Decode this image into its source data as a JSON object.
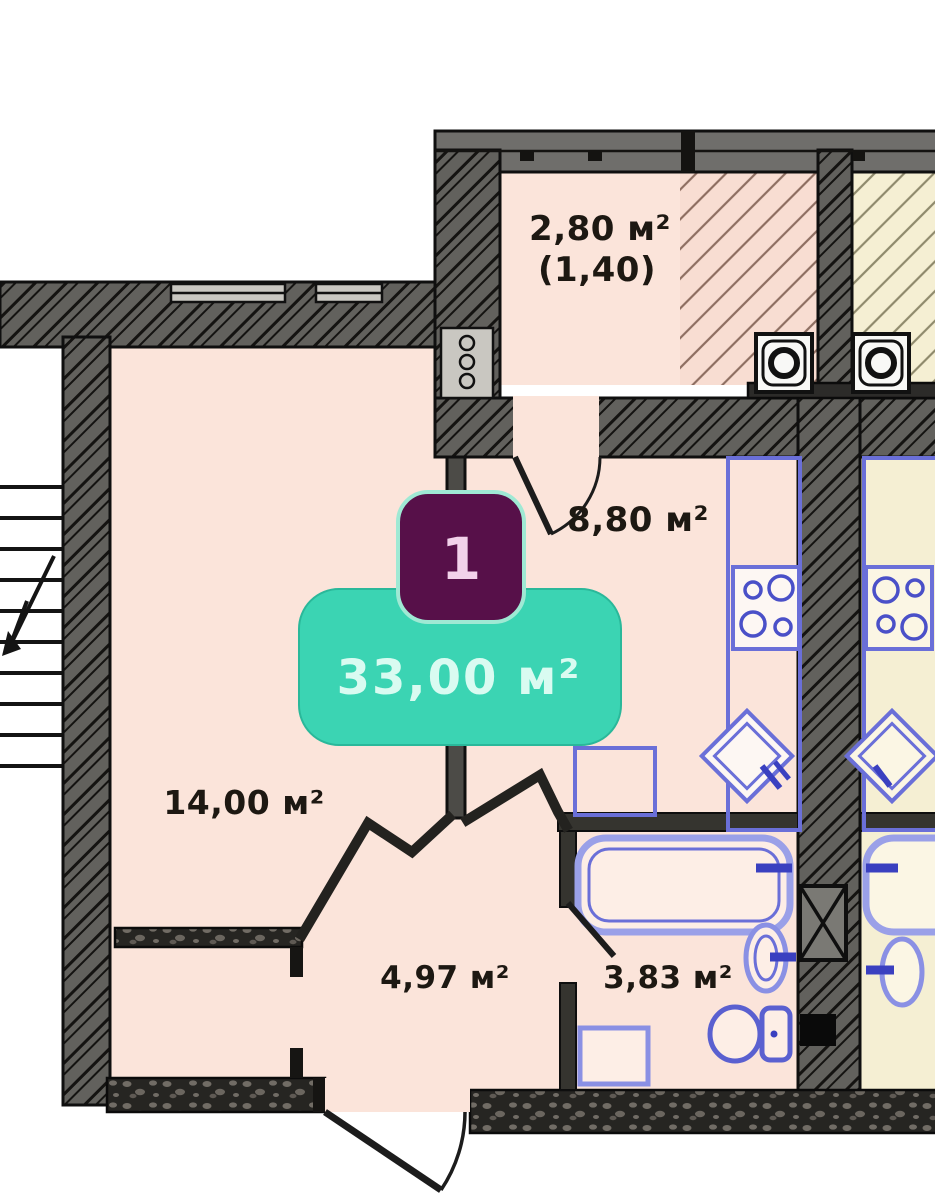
{
  "plan": {
    "title": "apartment-floor-plan",
    "badge": {
      "unit_number": "1",
      "total_area": "33,00 м²"
    },
    "labels": {
      "balcony_area": "2,80 м²",
      "balcony_coeff": "(1,40)",
      "kitchen_area": "8,80 м²",
      "living_area": "14,00 м²",
      "hall_area": "4,97 м²",
      "bath_area": "3,83 м²"
    },
    "colors": {
      "room_fill": "#fbe4da",
      "neighbor_fill": "#f5efd3",
      "wall_gray": "#62615d",
      "dark_wall": "#262522",
      "accent_teal": "#3bd4b3",
      "accent_purple": "#571049",
      "fixture_blue": "#6a6fd8",
      "label_ink": "#1d1812"
    },
    "fixtures": [
      "stairs",
      "stove",
      "kitchen-sink",
      "countertop",
      "bathtub",
      "washbasin",
      "toilet",
      "washing-machine-slot",
      "ventilation-box",
      "shaft"
    ]
  }
}
